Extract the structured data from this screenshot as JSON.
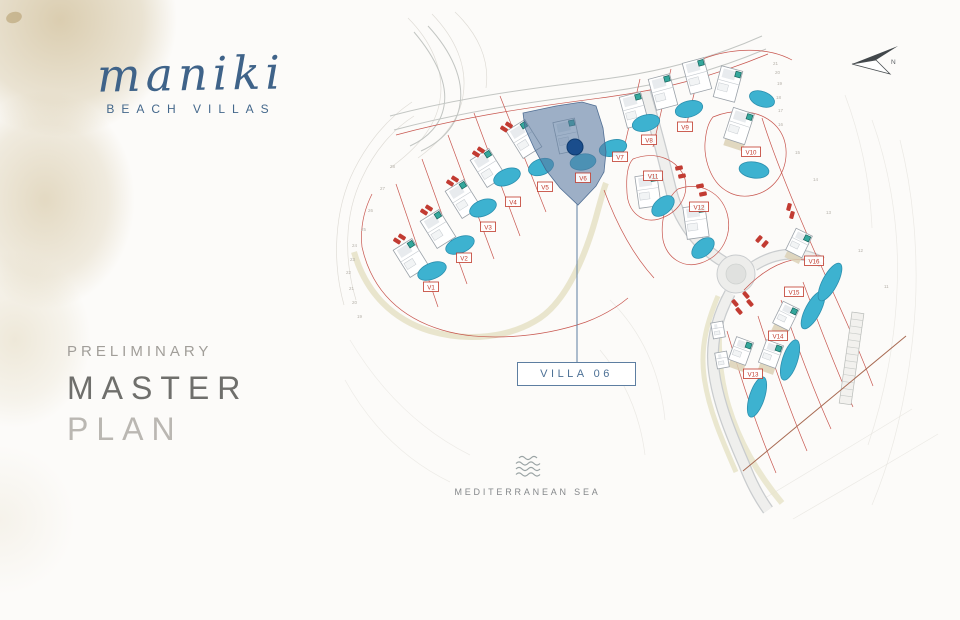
{
  "brand": {
    "name": "maniki",
    "tagline": "BEACH VILLAS"
  },
  "title_block": {
    "eyebrow": "PRELIMINARY",
    "line1": "MASTER",
    "line2": "PLAN"
  },
  "callout": {
    "label": "VILLA 06"
  },
  "sea": {
    "label": "MEDITERRANEAN SEA"
  },
  "compass": {
    "label": "N"
  },
  "colors": {
    "brand_blue": "#3f6389",
    "title_gray_dark": "#6f6f6c",
    "title_gray_light": "#bab7b2",
    "highlight_fill": "#5878a0",
    "marker_blue": "#1a4d8c",
    "pool_fill": "#3db2d0",
    "pool_edge": "#2b8fae",
    "plot_red": "#c2453d",
    "label_red": "#c0392b",
    "building_stroke": "#9aa1a8",
    "road_gray": "#c9ccce",
    "sand_path": "#e8e4ca",
    "teal_square": "#34a79c",
    "coast_line": "#a86a52"
  },
  "map": {
    "highlighted_villa": "V6",
    "marker": {
      "x": 575,
      "y": 147,
      "r": 8
    },
    "villas": [
      {
        "id": "V1",
        "label": "V1",
        "lx": 431,
        "ly": 287,
        "bx": 411,
        "by": 258,
        "rot": -32,
        "px": 432,
        "py": 271,
        "prx": 15,
        "pry": 8,
        "prot": -22,
        "type": "standard"
      },
      {
        "id": "V2",
        "label": "V2",
        "lx": 464,
        "ly": 258,
        "bx": 438,
        "by": 229,
        "rot": -32,
        "px": 460,
        "py": 245,
        "prx": 15,
        "pry": 8,
        "prot": -22,
        "type": "standard"
      },
      {
        "id": "V3",
        "label": "V3",
        "lx": 488,
        "ly": 227,
        "bx": 463,
        "by": 199,
        "rot": -32,
        "px": 483,
        "py": 208,
        "prx": 14,
        "pry": 8,
        "prot": -22,
        "type": "standard"
      },
      {
        "id": "V4",
        "label": "V4",
        "lx": 513,
        "ly": 202,
        "bx": 488,
        "by": 168,
        "rot": -32,
        "px": 507,
        "py": 177,
        "prx": 14,
        "pry": 8,
        "prot": -22,
        "type": "standard"
      },
      {
        "id": "V5",
        "label": "V5",
        "lx": 545,
        "ly": 187,
        "bx": 524,
        "by": 139,
        "rot": -32,
        "px": 541,
        "py": 167,
        "prx": 13,
        "pry": 8,
        "prot": -20,
        "type": "standard"
      },
      {
        "id": "V6",
        "label": "V6",
        "lx": 583,
        "ly": 178,
        "bx": 567,
        "by": 136,
        "rot": -12,
        "px": 583,
        "py": 162,
        "prx": 13,
        "pry": 8,
        "prot": -10,
        "type": "standard",
        "highlighted": true
      },
      {
        "id": "V7",
        "label": "V7",
        "lx": 620,
        "ly": 157,
        "bx": 634,
        "by": 110,
        "rot": -15,
        "px": 613,
        "py": 148,
        "prx": 14,
        "pry": 8,
        "prot": -15,
        "type": "standard"
      },
      {
        "id": "V8",
        "label": "V8",
        "lx": 649,
        "ly": 140,
        "bx": 663,
        "by": 92,
        "rot": -15,
        "px": 646,
        "py": 123,
        "prx": 14,
        "pry": 8,
        "prot": -15,
        "type": "standard"
      },
      {
        "id": "V9",
        "label": "V9",
        "lx": 685,
        "ly": 127,
        "bx": 697,
        "by": 76,
        "rot": -15,
        "px": 689,
        "py": 109,
        "prx": 14,
        "pry": 8,
        "prot": -15,
        "type": "standard"
      },
      {
        "id": "VA",
        "label": "",
        "bx": 728,
        "by": 84,
        "rot": 15,
        "px": 762,
        "py": 99,
        "prx": 13,
        "pry": 7.5,
        "prot": 20,
        "type": "standard"
      },
      {
        "id": "V10",
        "label": "V10",
        "lx": 751,
        "ly": 152,
        "bx": 739,
        "by": 126,
        "rot": 18,
        "px": 754,
        "py": 170,
        "prx": 15,
        "pry": 8,
        "prot": 8,
        "type": "standard",
        "tan": true
      },
      {
        "id": "V11",
        "label": "V11",
        "lx": 653,
        "ly": 176,
        "bx": 648,
        "by": 191,
        "rot": -8,
        "px": 663,
        "py": 206,
        "prx": 13,
        "pry": 8,
        "prot": -40,
        "type": "standard"
      },
      {
        "id": "V12",
        "label": "V12",
        "lx": 699,
        "ly": 207,
        "bx": 696,
        "by": 222,
        "rot": -8,
        "px": 703,
        "py": 248,
        "prx": 13,
        "pry": 8,
        "prot": -40,
        "type": "standard"
      },
      {
        "id": "V13",
        "label": "V13",
        "lx": 753,
        "ly": 374,
        "bx": 741,
        "by": 351,
        "rot": 20,
        "px": 757,
        "py": 397,
        "prx": 7.5,
        "pry": 21,
        "prot": 18,
        "type": "strip",
        "tan": true
      },
      {
        "id": "V14",
        "label": "V14",
        "lx": 778,
        "ly": 336,
        "bx": 771,
        "by": 354,
        "rot": 20,
        "px": 790,
        "py": 360,
        "prx": 7.5,
        "pry": 21,
        "prot": 18,
        "type": "strip",
        "tan": true
      },
      {
        "id": "V15",
        "label": "V15",
        "lx": 794,
        "ly": 292,
        "bx": 786,
        "by": 316,
        "rot": 26,
        "px": 813,
        "py": 310,
        "prx": 7.5,
        "pry": 21,
        "prot": 28,
        "type": "strip",
        "tan": true
      },
      {
        "id": "V16",
        "label": "V16",
        "lx": 814,
        "ly": 261,
        "bx": 799,
        "by": 243,
        "rot": 26,
        "px": 830,
        "py": 282,
        "prx": 7.5,
        "pry": 21,
        "prot": 28,
        "type": "strip",
        "tan": true
      },
      {
        "id": "X1",
        "label": "",
        "bx": 718,
        "by": 330,
        "rot": -10,
        "type": "small"
      },
      {
        "id": "X2",
        "label": "",
        "bx": 722,
        "by": 360,
        "rot": -10,
        "type": "small"
      }
    ],
    "cars": [
      [
        397,
        241,
        -58
      ],
      [
        402,
        237,
        -58
      ],
      [
        424,
        212,
        -58
      ],
      [
        429,
        208,
        -58
      ],
      [
        450,
        183,
        -58
      ],
      [
        455,
        179,
        -58
      ],
      [
        476,
        154,
        -58
      ],
      [
        481,
        150,
        -58
      ],
      [
        504,
        129,
        -58
      ],
      [
        509,
        125,
        -58
      ],
      [
        679,
        168,
        78
      ],
      [
        682,
        176,
        78
      ],
      [
        700,
        186,
        78
      ],
      [
        703,
        194,
        78
      ],
      [
        789,
        207,
        15
      ],
      [
        792,
        215,
        15
      ],
      [
        759,
        239,
        40
      ],
      [
        765,
        244,
        40
      ],
      [
        735,
        303,
        -40
      ],
      [
        739,
        311,
        -40
      ],
      [
        746,
        295,
        -40
      ],
      [
        750,
        303,
        -40
      ]
    ],
    "elevations": [
      [
        "28",
        390,
        168
      ],
      [
        "27",
        380,
        190
      ],
      [
        "26",
        368,
        212
      ],
      [
        "25",
        361,
        231
      ],
      [
        "24",
        352,
        247
      ],
      [
        "23",
        350,
        261
      ],
      [
        "22",
        346,
        274
      ],
      [
        "21",
        349,
        290
      ],
      [
        "20",
        352,
        304
      ],
      [
        "19",
        357,
        318
      ],
      [
        "21",
        773,
        65
      ],
      [
        "20",
        775,
        74
      ],
      [
        "19",
        777,
        85
      ],
      [
        "18",
        776,
        99
      ],
      [
        "17",
        778,
        112
      ],
      [
        "16",
        778,
        126
      ],
      [
        "15",
        795,
        154
      ],
      [
        "14",
        813,
        181
      ],
      [
        "13",
        826,
        214
      ],
      [
        "12",
        858,
        252
      ],
      [
        "11",
        884,
        288
      ]
    ]
  }
}
